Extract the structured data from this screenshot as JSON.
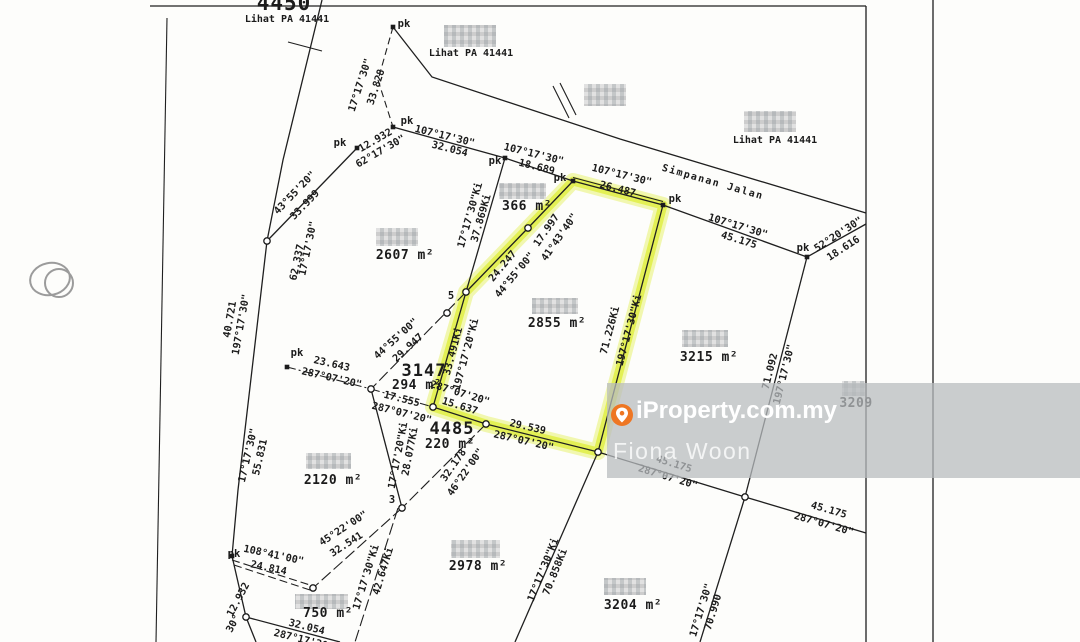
{
  "watermark": {
    "brand": "iProperty.com.my",
    "agent": "Fiona Woon",
    "brand_color": "#ee7623",
    "band_color": "rgba(184,188,190,0.74)"
  },
  "map": {
    "highlight_color": "#e3ef52",
    "line_color": "#1f1f1f",
    "labels": [
      {
        "t": "4450",
        "x": 284,
        "y": 10,
        "r": 0,
        "s": 21,
        "c": "big",
        "n": "lot-number-4450"
      },
      {
        "t": "Lihat PA 41441",
        "x": 287,
        "y": 22,
        "r": 0,
        "s": 10,
        "n": "reference-note"
      },
      {
        "t": "Lihat PA 41441",
        "x": 471,
        "y": 56,
        "r": 0,
        "s": 10,
        "n": "reference-note"
      },
      {
        "t": "Lihat PA 41441",
        "x": 775,
        "y": 143,
        "r": 0,
        "s": 10,
        "n": "reference-note"
      },
      {
        "t": "pk",
        "x": 404,
        "y": 27,
        "r": 0,
        "s": 10.5,
        "n": "pk-label"
      },
      {
        "t": "17°17'30\"",
        "x": 363,
        "y": 86,
        "r": -72,
        "s": 10.2,
        "n": "bearing-label"
      },
      {
        "t": "33.828",
        "x": 379,
        "y": 88,
        "r": -72,
        "s": 10.2,
        "n": "distance-label"
      },
      {
        "t": "pk",
        "x": 407,
        "y": 124,
        "r": 0,
        "s": 10.5,
        "n": "pk-label"
      },
      {
        "t": "pk",
        "x": 340,
        "y": 146,
        "r": 0,
        "s": 10.5,
        "n": "pk-label"
      },
      {
        "t": "12.932",
        "x": 377,
        "y": 143,
        "r": -30,
        "s": 10.2,
        "n": "distance-label"
      },
      {
        "t": "62°17'30\"",
        "x": 382,
        "y": 154,
        "r": -30,
        "s": 10.2,
        "n": "bearing-label"
      },
      {
        "t": "107°17'30\"",
        "x": 444,
        "y": 139,
        "r": 14,
        "s": 10.2,
        "n": "bearing-label"
      },
      {
        "t": "32.054",
        "x": 449,
        "y": 152,
        "r": 14,
        "s": 10.2,
        "n": "distance-label"
      },
      {
        "t": "pk",
        "x": 495,
        "y": 164,
        "r": 0,
        "s": 10.5,
        "n": "pk-label"
      },
      {
        "t": "107°17'30\"",
        "x": 533,
        "y": 157,
        "r": 14,
        "s": 10.2,
        "n": "bearing-label"
      },
      {
        "t": "18.689",
        "x": 536,
        "y": 170,
        "r": 14,
        "s": 10.2,
        "n": "distance-label"
      },
      {
        "t": "pk",
        "x": 560,
        "y": 181,
        "r": 0,
        "s": 10.5,
        "n": "pk-label"
      },
      {
        "t": "107°17'30\"",
        "x": 621,
        "y": 178,
        "r": 14,
        "s": 10.2,
        "n": "bearing-label"
      },
      {
        "t": "26.487",
        "x": 617,
        "y": 192,
        "r": 14,
        "s": 10.2,
        "n": "distance-label"
      },
      {
        "t": "pk",
        "x": 675,
        "y": 202,
        "r": 0,
        "s": 10.5,
        "n": "pk-label"
      },
      {
        "t": "Simpanan Jalan",
        "x": 712,
        "y": 185,
        "r": 16,
        "s": 10,
        "c": "road",
        "n": "road-name"
      },
      {
        "t": "107°17'30\"",
        "x": 737,
        "y": 229,
        "r": 17,
        "s": 10.2,
        "n": "bearing-label"
      },
      {
        "t": "45.175",
        "x": 738,
        "y": 243,
        "r": 17,
        "s": 10.2,
        "n": "distance-label"
      },
      {
        "t": "pk",
        "x": 803,
        "y": 251,
        "r": 0,
        "s": 10.5,
        "n": "pk-label"
      },
      {
        "t": "52°20'30\"",
        "x": 840,
        "y": 237,
        "r": -33,
        "s": 10.2,
        "n": "bearing-label"
      },
      {
        "t": "18.616",
        "x": 845,
        "y": 251,
        "r": -33,
        "s": 10.2,
        "n": "distance-label"
      },
      {
        "t": "366 m²",
        "x": 527,
        "y": 210,
        "r": 0,
        "s": 13,
        "c": "area",
        "n": "lot-area"
      },
      {
        "t": "17.997",
        "x": 549,
        "y": 232,
        "r": -55,
        "s": 10.2,
        "n": "distance-label"
      },
      {
        "t": "41°43'40\"",
        "x": 562,
        "y": 239,
        "r": -55,
        "s": 10.2,
        "n": "bearing-label"
      },
      {
        "t": "17°17'30\"Ki",
        "x": 473,
        "y": 216,
        "r": -74,
        "s": 10.2,
        "n": "bearing-label"
      },
      {
        "t": "37.869Ki",
        "x": 484,
        "y": 219,
        "r": -74,
        "s": 10.2,
        "n": "distance-label"
      },
      {
        "t": "24.247",
        "x": 505,
        "y": 268,
        "r": -50,
        "s": 10.2,
        "n": "distance-label"
      },
      {
        "t": "44°55'00\"",
        "x": 517,
        "y": 277,
        "r": -50,
        "s": 10.2,
        "n": "bearing-label"
      },
      {
        "t": "2607 m²",
        "x": 405,
        "y": 259,
        "r": 0,
        "s": 13,
        "c": "area",
        "n": "lot-area"
      },
      {
        "t": "43°55'20\"",
        "x": 297,
        "y": 195,
        "r": -46,
        "s": 10.2,
        "n": "bearing-label"
      },
      {
        "t": "33.999",
        "x": 307,
        "y": 207,
        "r": -46,
        "s": 10.2,
        "n": "distance-label"
      },
      {
        "t": "17°17'30\"",
        "x": 311,
        "y": 249,
        "r": -78,
        "s": 10.2,
        "n": "bearing-label"
      },
      {
        "t": "62.337",
        "x": 300,
        "y": 263,
        "r": -78,
        "s": 10.2,
        "n": "distance-label"
      },
      {
        "t": "197°17'30\"",
        "x": 244,
        "y": 325,
        "r": -80,
        "s": 10.2,
        "n": "bearing-label"
      },
      {
        "t": "40.721",
        "x": 233,
        "y": 320,
        "r": -80,
        "s": 10.2,
        "n": "distance-label"
      },
      {
        "t": "pk",
        "x": 297,
        "y": 356,
        "r": 0,
        "s": 10.5,
        "n": "pk-label"
      },
      {
        "t": "23.643",
        "x": 331,
        "y": 367,
        "r": 13,
        "s": 10.2,
        "n": "distance-label"
      },
      {
        "t": "287°07'20\"",
        "x": 331,
        "y": 381,
        "r": 13,
        "s": 10.2,
        "n": "bearing-label"
      },
      {
        "t": "3147",
        "x": 424,
        "y": 376,
        "r": 0,
        "s": 17,
        "c": "big",
        "n": "lot-number-3147"
      },
      {
        "t": "294 m²",
        "x": 417,
        "y": 389,
        "r": 0,
        "s": 13,
        "c": "area",
        "n": "lot-area"
      },
      {
        "t": "44°55'00\"",
        "x": 398,
        "y": 341,
        "r": -42,
        "s": 10.2,
        "n": "bearing-label"
      },
      {
        "t": "29.947",
        "x": 410,
        "y": 350,
        "r": -42,
        "s": 10.2,
        "n": "distance-label"
      },
      {
        "t": "5",
        "x": 451,
        "y": 299,
        "r": 0,
        "s": 10.5,
        "n": "node-number"
      },
      {
        "t": "33.491Ki",
        "x": 456,
        "y": 352,
        "r": -75,
        "s": 10.2,
        "n": "distance-label"
      },
      {
        "t": "197°17'20\"Ki",
        "x": 469,
        "y": 355,
        "r": -75,
        "s": 10.2,
        "n": "bearing-label"
      },
      {
        "t": "2855 m²",
        "x": 557,
        "y": 327,
        "r": 0,
        "s": 13,
        "c": "area",
        "n": "highlighted-lot-area"
      },
      {
        "t": "71.226Ki",
        "x": 613,
        "y": 331,
        "r": -75,
        "s": 10.2,
        "n": "distance-label"
      },
      {
        "t": "197°17'30\"Ki",
        "x": 632,
        "y": 331,
        "r": -75,
        "s": 10.2,
        "n": "bearing-label"
      },
      {
        "t": "3215 m²",
        "x": 709,
        "y": 361,
        "r": 0,
        "s": 13,
        "c": "area",
        "n": "lot-area"
      },
      {
        "t": "17.555",
        "x": 401,
        "y": 402,
        "r": 14,
        "s": 10.2,
        "n": "distance-label"
      },
      {
        "t": "287°07'20\"",
        "x": 401,
        "y": 416,
        "r": 14,
        "s": 10.2,
        "n": "bearing-label"
      },
      {
        "t": "287°07'20\"",
        "x": 459,
        "y": 396,
        "r": 17,
        "s": 10.2,
        "n": "bearing-label"
      },
      {
        "t": "15.637",
        "x": 459,
        "y": 409,
        "r": 17,
        "s": 10.2,
        "n": "distance-label"
      },
      {
        "t": "4485",
        "x": 452,
        "y": 434,
        "r": 0,
        "s": 17,
        "c": "big",
        "n": "lot-number-4485"
      },
      {
        "t": "220 m²",
        "x": 450,
        "y": 448,
        "r": 0,
        "s": 13,
        "c": "area",
        "n": "lot-area"
      },
      {
        "t": "29.539",
        "x": 527,
        "y": 430,
        "r": 13,
        "s": 10.2,
        "n": "distance-label"
      },
      {
        "t": "287°07'20\"",
        "x": 523,
        "y": 444,
        "r": 13,
        "s": 10.2,
        "n": "bearing-label"
      },
      {
        "t": "17°17'20\"Ki",
        "x": 401,
        "y": 456,
        "r": -79,
        "s": 10.2,
        "n": "bearing-label"
      },
      {
        "t": "28.077Ki",
        "x": 413,
        "y": 452,
        "r": -79,
        "s": 10.2,
        "n": "distance-label"
      },
      {
        "t": "32.178",
        "x": 456,
        "y": 467,
        "r": -55,
        "s": 10.2,
        "n": "distance-label"
      },
      {
        "t": "46°22'00\"",
        "x": 468,
        "y": 474,
        "r": -55,
        "s": 10.2,
        "n": "bearing-label"
      },
      {
        "t": "3",
        "x": 392,
        "y": 503,
        "r": 0,
        "s": 10.5,
        "n": "node-number"
      },
      {
        "t": "17°17'30\"",
        "x": 251,
        "y": 456,
        "r": -77,
        "s": 10.2,
        "n": "bearing-label"
      },
      {
        "t": "55.831",
        "x": 263,
        "y": 458,
        "r": -77,
        "s": 10.2,
        "n": "distance-label"
      },
      {
        "t": "2120 m²",
        "x": 333,
        "y": 484,
        "r": 0,
        "s": 13,
        "c": "area",
        "n": "lot-area"
      },
      {
        "t": "45°22'00\"",
        "x": 345,
        "y": 531,
        "r": -33,
        "s": 10.2,
        "n": "bearing-label"
      },
      {
        "t": "32.541",
        "x": 348,
        "y": 547,
        "r": -33,
        "s": 10.2,
        "n": "distance-label"
      },
      {
        "t": "pk",
        "x": 234,
        "y": 557,
        "r": 0,
        "s": 10.5,
        "n": "pk-label"
      },
      {
        "t": "108°41'00\"",
        "x": 273,
        "y": 558,
        "r": 12,
        "s": 10.2,
        "n": "bearing-label"
      },
      {
        "t": "24.814",
        "x": 268,
        "y": 571,
        "r": 12,
        "s": 10.2,
        "n": "distance-label"
      },
      {
        "t": "12.932",
        "x": 241,
        "y": 601,
        "r": -62,
        "s": 10.2,
        "n": "distance-label"
      },
      {
        "t": "30°",
        "x": 236,
        "y": 625,
        "r": -62,
        "s": 10.2,
        "n": "bearing-label"
      },
      {
        "t": "2978 m²",
        "x": 478,
        "y": 570,
        "r": 0,
        "s": 13,
        "c": "area",
        "n": "lot-area"
      },
      {
        "t": "17°17'30\"Ki",
        "x": 369,
        "y": 578,
        "r": -73,
        "s": 10.2,
        "n": "bearing-label"
      },
      {
        "t": "42.647Ki",
        "x": 386,
        "y": 572,
        "r": -73,
        "s": 10.2,
        "n": "distance-label"
      },
      {
        "t": "750 m²",
        "x": 328,
        "y": 617,
        "r": 0,
        "s": 13,
        "c": "area",
        "n": "lot-area"
      },
      {
        "t": "32.054",
        "x": 306,
        "y": 630,
        "r": 14,
        "s": 10.2,
        "n": "distance-label"
      },
      {
        "t": "287°17'30\"",
        "x": 303,
        "y": 643,
        "r": 14,
        "s": 10.2,
        "n": "bearing-label"
      },
      {
        "t": "3204 m²",
        "x": 633,
        "y": 609,
        "r": 0,
        "s": 13,
        "c": "area",
        "n": "lot-area"
      },
      {
        "t": "17°17'30\"Ki",
        "x": 546,
        "y": 571,
        "r": -68,
        "s": 10.2,
        "n": "bearing-label"
      },
      {
        "t": "70.858Ki",
        "x": 558,
        "y": 573,
        "r": -68,
        "s": 10.2,
        "n": "distance-label"
      },
      {
        "t": "17°17'30\"",
        "x": 704,
        "y": 611,
        "r": -73,
        "s": 10.2,
        "n": "bearing-label"
      },
      {
        "t": "70.990",
        "x": 716,
        "y": 613,
        "r": -73,
        "s": 10.2,
        "n": "distance-label"
      },
      {
        "t": "71.092",
        "x": 773,
        "y": 372,
        "r": -76,
        "s": 10.2,
        "n": "distance-label"
      },
      {
        "t": "197°17'30\"",
        "x": 787,
        "y": 375,
        "r": -76,
        "s": 10.2,
        "n": "bearing-label"
      },
      {
        "t": "45.175",
        "x": 673,
        "y": 467,
        "r": 17,
        "s": 10.2,
        "n": "distance-label"
      },
      {
        "t": "287°07'20\"",
        "x": 667,
        "y": 480,
        "r": 17,
        "s": 10.2,
        "n": "bearing-label"
      },
      {
        "t": "45.175",
        "x": 828,
        "y": 513,
        "r": 16,
        "s": 10.2,
        "n": "distance-label"
      },
      {
        "t": "287°07'20\"",
        "x": 823,
        "y": 527,
        "r": 16,
        "s": 10.2,
        "n": "bearing-label"
      },
      {
        "t": "3209",
        "x": 856,
        "y": 407,
        "r": 0,
        "s": 13,
        "c": "area",
        "n": "lot-number-3209"
      }
    ],
    "pk_markers": [
      [
        393,
        27
      ],
      [
        393,
        127
      ],
      [
        357,
        148
      ],
      [
        505,
        158
      ],
      [
        573,
        181
      ],
      [
        663,
        205
      ],
      [
        807,
        257
      ],
      [
        287,
        367
      ],
      [
        232,
        556
      ]
    ],
    "nodes": [
      [
        267,
        241
      ],
      [
        528,
        228
      ],
      [
        447,
        313
      ],
      [
        371,
        389
      ],
      [
        433,
        407
      ],
      [
        486,
        424
      ],
      [
        402,
        508
      ],
      [
        313,
        588
      ],
      [
        246,
        617
      ],
      [
        745,
        497
      ],
      [
        598,
        452
      ],
      [
        466,
        292
      ]
    ],
    "redactions": [
      [
        444,
        25,
        52,
        22
      ],
      [
        584,
        84,
        42,
        22
      ],
      [
        744,
        111,
        52,
        21
      ],
      [
        376,
        228,
        42,
        18
      ],
      [
        499,
        183,
        47,
        16
      ],
      [
        532,
        298,
        46,
        16
      ],
      [
        682,
        330,
        46,
        17
      ],
      [
        842,
        381,
        23,
        15
      ],
      [
        306,
        453,
        45,
        16
      ],
      [
        451,
        540,
        49,
        18
      ],
      [
        604,
        578,
        42,
        17
      ],
      [
        295,
        594,
        53,
        15
      ]
    ]
  }
}
